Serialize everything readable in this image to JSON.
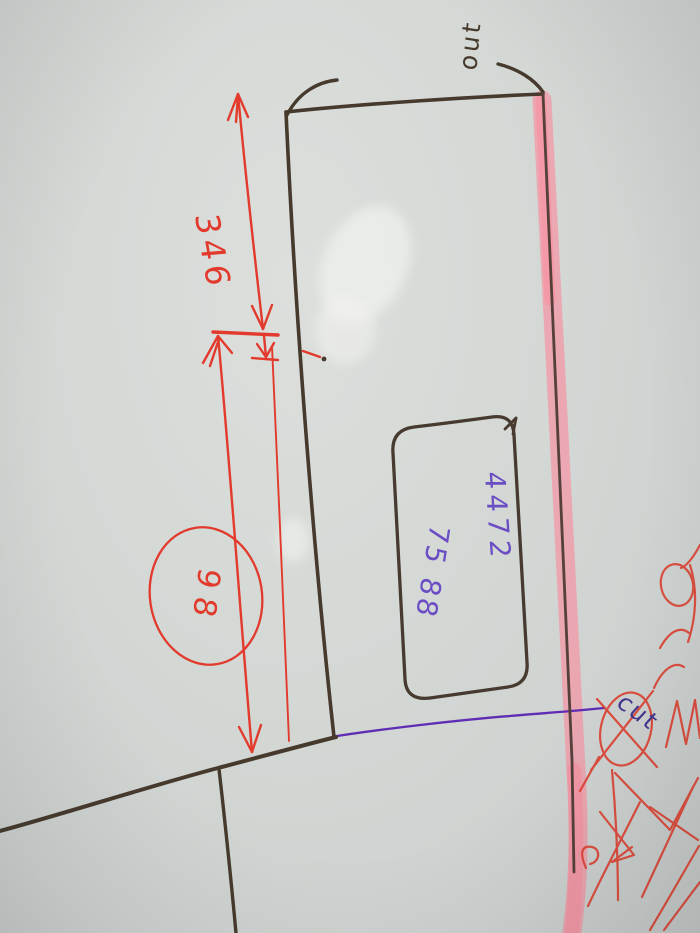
{
  "scene": {
    "description": "Photographed hand-drawn panel cutting sketch, rotated sideways on grey paper"
  },
  "labels": {
    "out": "out",
    "cut": "cut",
    "dimension_346": "346",
    "circle_value": "98",
    "cutout_line1": "4472",
    "cutout_line2": "75 88"
  },
  "colors": {
    "paper": "#d4d8d5",
    "marker_black": "#463a2d",
    "pen_red": "#e23a2c",
    "cut_line_purple": "#5e2db4",
    "handwriting_purple": "#6b4ec4",
    "highlighter_pink": "#ff8296"
  }
}
